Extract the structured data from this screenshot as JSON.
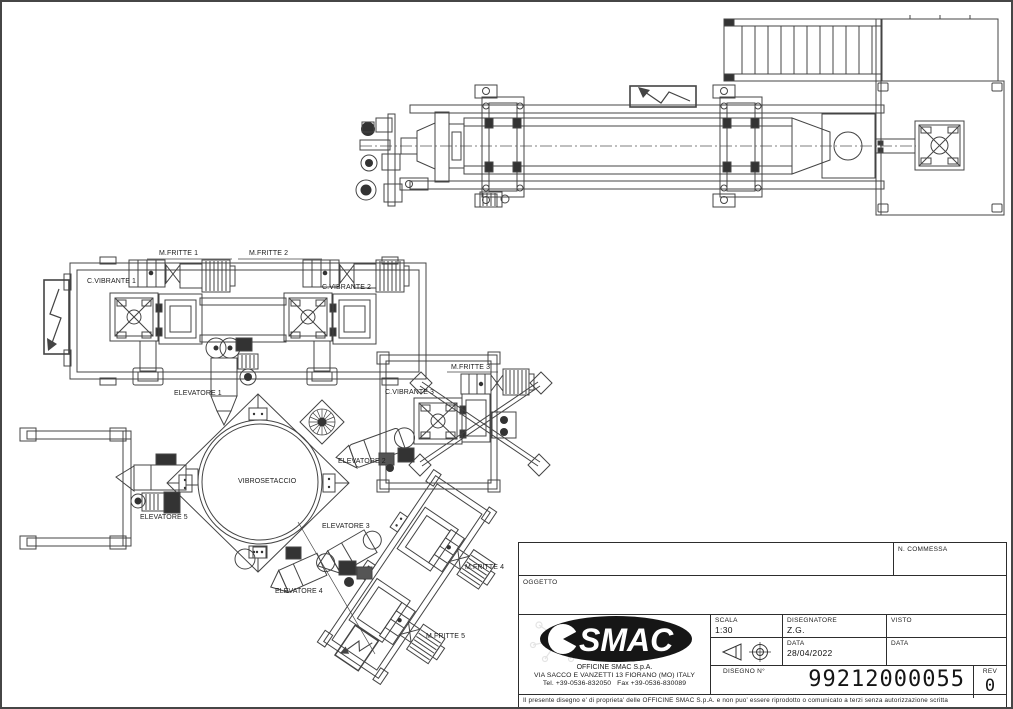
{
  "drawing": {
    "labels": {
      "m_fritte_1": "M.FRITTE 1",
      "m_fritte_2": "M.FRITTE 2",
      "m_fritte_3": "M.FRITTE 3",
      "m_fritte_4": "M.FRITTE 4",
      "m_fritte_5": "M.FRITTE 5",
      "c_vibrante_1": "C.VIBRANTE 1",
      "c_vibrante_2": "C.VIBRANTE 2",
      "c_vibrante_3": "C.VIBRANTE 3",
      "elevatore_1": "ELEVATORE 1",
      "elevatore_2": "ELEVATORE 2",
      "elevatore_3": "ELEVATORE 3",
      "elevatore_4": "ELEVATORE 4",
      "elevatore_5": "ELEVATORE 5",
      "vibrosetaccio": "VIBROSETACCIO"
    },
    "line_color": "#444444"
  },
  "title_block": {
    "n_commessa_label": "N. COMMESSA",
    "oggetto_label": "OGGETTO",
    "scala_label": "SCALA",
    "scala_value": "1:30",
    "disegnatore_label": "DISEGNATORE",
    "disegnatore_value": "Z.G.",
    "visto_label": "VISTO",
    "data_label": "DATA",
    "data_value": "28/04/2022",
    "data2_label": "DATA",
    "disegno_label": "DISEGNO N°",
    "disegno_value": "99212000055",
    "rev_label": "REV",
    "rev_value": "0",
    "logo_text": "SMAC",
    "company_name": "OFFICINE SMAC S.p.A.",
    "company_address": "VIA SACCO E VANZETTI 13 FIORANO (MO) ITALY",
    "company_phone": "Tel. +39-0536-832050   Fax +39-0536-830089",
    "disclaimer": "Il presente disegno e' di proprieta' delle OFFICINE SMAC S.p.A. e non puo' essere riprodotto o comunicato a terzi senza autorizzazione scritta"
  }
}
